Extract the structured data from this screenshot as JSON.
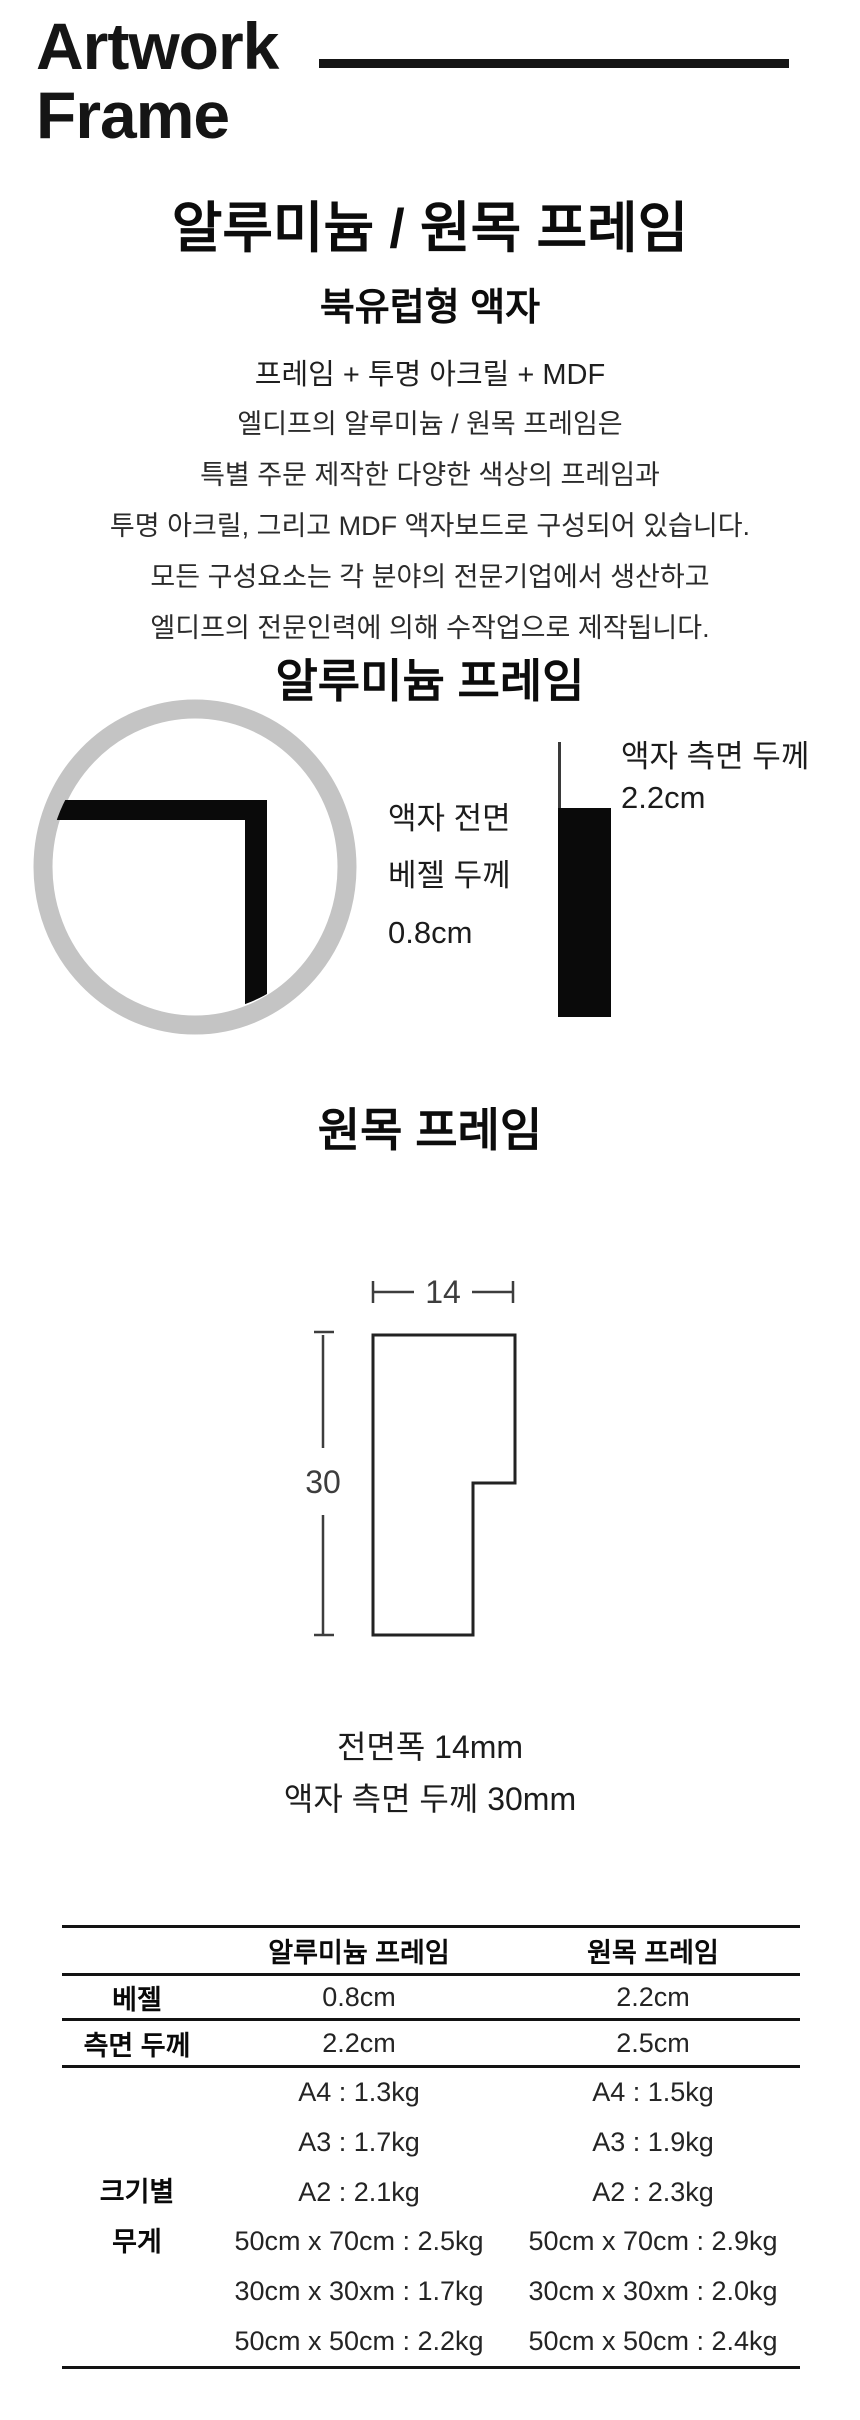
{
  "logo": {
    "line1": "Artwork",
    "line2": "Frame"
  },
  "intro": {
    "title": "알루미늄 / 원목 프레임",
    "subtitle": "북유럽형 액자",
    "composition": "프레임 + 투명 아크릴 + MDF",
    "description_lines": [
      "엘디프의 알루미늄 / 원목 프레임은",
      "특별 주문 제작한 다양한 색상의 프레임과",
      "투명 아크릴, 그리고 MDF 액자보드로 구성되어 있습니다.",
      "모든 구성요소는 각 분야의 전문기업에서 생산하고",
      "엘디프의 전문인력에 의해 수작업으로 제작됩니다."
    ]
  },
  "aluminum_section": {
    "heading": "알루미늄 프레임",
    "front_label_lines": [
      "액자 전면",
      "베젤 두께",
      "0.8cm"
    ],
    "side_label_lines": [
      "액자 측면 두께",
      "2.2cm"
    ]
  },
  "wood_section": {
    "heading": "원목 프레임",
    "dim_width": "14",
    "dim_height": "30",
    "caption_lines": [
      "전면폭 14mm",
      "액자 측면 두께 30mm"
    ]
  },
  "spec_table": {
    "columns": [
      "",
      "알루미늄 프레임",
      "원목 프레임"
    ],
    "rows": [
      {
        "label": "베젤",
        "aluminum": "0.8cm",
        "wood": "2.2cm"
      },
      {
        "label": "측면 두께",
        "aluminum": "2.2cm",
        "wood": "2.5cm"
      }
    ],
    "weight_row": {
      "label_lines": [
        "크기별",
        "무게"
      ],
      "aluminum": [
        "A4 : 1.3kg",
        "A3 : 1.7kg",
        "A2 : 2.1kg",
        "50cm x 70cm : 2.5kg",
        "30cm x 30xm : 1.7kg",
        "50cm x 50cm : 2.2kg"
      ],
      "wood": [
        "A4 : 1.5kg",
        "A3 : 1.9kg",
        "A2 : 2.3kg",
        "50cm x 70cm : 2.9kg",
        "30cm x 30xm : 2.0kg",
        "50cm x 50cm : 2.4kg"
      ]
    }
  },
  "colors": {
    "circle_gray": "#c4c4c4",
    "ink": "#131313",
    "dim_gray": "#3d3d3d"
  }
}
